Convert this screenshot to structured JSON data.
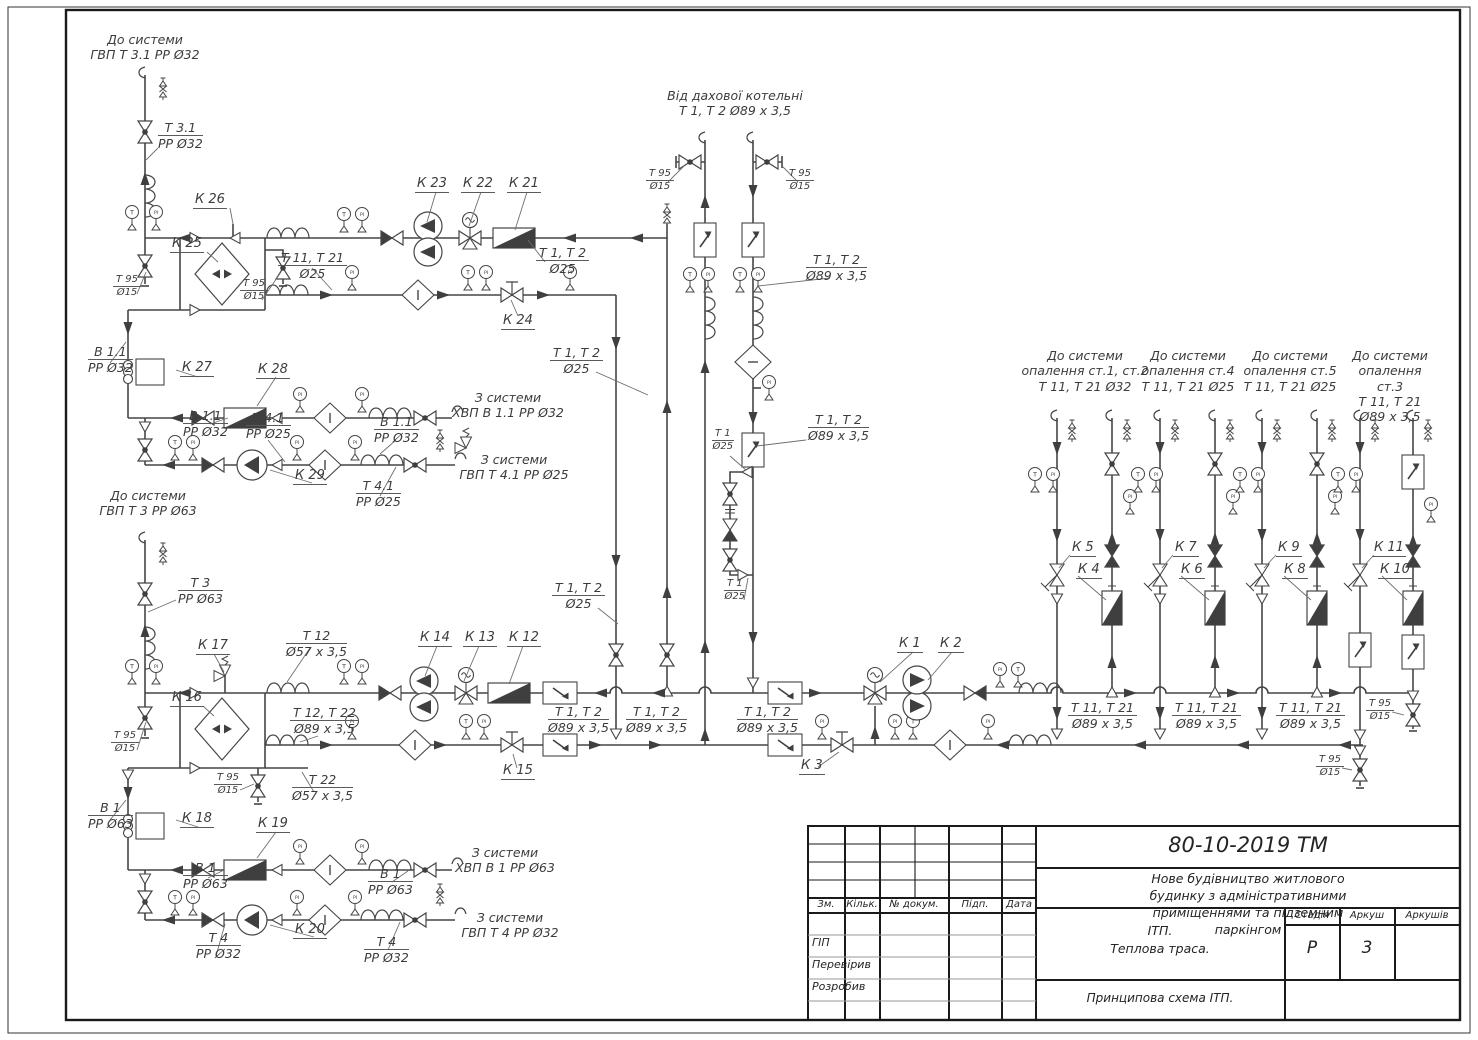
{
  "headers": {
    "to_gvp31": "До системи\nГВП Т 3.1 РР Ø32",
    "from_roof": "Від дахової котельні\nТ 1, Т 2 Ø89 х 3,5",
    "to_gvp3": "До системи\nГВП Т 3 РР Ø63",
    "to_heat_st12": "До системи\nопалення ст.1, ст.2\nТ 11, Т 21 Ø32",
    "to_heat_st4": "До системи\nопалення ст.4\nТ 11, Т 21 Ø25",
    "to_heat_st5": "До системи\nопалення ст.5\nТ 11, Т 21 Ø25",
    "to_heat_st3": "До системи\nопалення ст.3\nТ 11, Т 21 Ø89 х 3,5",
    "from_hvp11": "З системи\nХВП В 1.1  РР Ø32",
    "from_gvp41": "З системи\nГВП Т 4.1  РР Ø25",
    "from_hvp1": "З системи\nХВП В 1  РР Ø63",
    "from_gvp4": "З системи\nГВП Т 4  РР Ø32"
  },
  "equipment": {
    "k1": "К 1",
    "k2": "К 2",
    "k3": "К 3",
    "k4": "К 4",
    "k5": "К 5",
    "k6": "К 6",
    "k7": "К 7",
    "k8": "К 8",
    "k9": "К 9",
    "k10": "К 10",
    "k11": "К 11",
    "k12": "К 12",
    "k13": "К 13",
    "k14": "К 14",
    "k15": "К 15",
    "k16": "К 16",
    "k17": "К 17",
    "k18": "К 18",
    "k19": "К 19",
    "k20": "К 20",
    "k21": "К 21",
    "k22": "К 22",
    "k23": "К 23",
    "k24": "К 24",
    "k25": "К 25",
    "k26": "К 26",
    "k27": "К 27",
    "k28": "К 28",
    "k29": "К 29"
  },
  "pipes": {
    "t31": {
      "a": "Т 3.1",
      "b": "РР Ø32"
    },
    "t95": {
      "a": "Т 95",
      "b": "Ø15"
    },
    "t11t21_25": {
      "a": "Т 11, Т 21",
      "b": "Ø25"
    },
    "t1t2_25": {
      "a": "Т 1, Т 2",
      "b": "Ø25"
    },
    "t1t2_89": {
      "a": "Т 1, Т 2",
      "b": "Ø89 х 3,5"
    },
    "t1_25": {
      "a": "Т 1",
      "b": "Ø25"
    },
    "b11": {
      "a": "В 1.1",
      "b": "РР Ø32"
    },
    "t41": {
      "a": "Т 4.1",
      "b": "РР Ø25"
    },
    "t3": {
      "a": "Т 3",
      "b": "РР Ø63"
    },
    "t12": {
      "a": "Т 12",
      "b": "Ø57 х 3,5"
    },
    "t12t22": {
      "a": "Т 12, Т 22",
      "b": "Ø89 х 3,5"
    },
    "t22": {
      "a": "Т 22",
      "b": "Ø57 х 3,5"
    },
    "b1": {
      "a": "В 1",
      "b": "РР Ø63"
    },
    "t4": {
      "a": "Т 4",
      "b": "РР Ø32"
    },
    "t11t21_89": {
      "a": "Т 11, Т 21",
      "b": "Ø89 х 3,5"
    }
  },
  "symbols": {
    "gauge_t": "Т",
    "gauge_pi": "РІ"
  },
  "title_block": {
    "doc_code": "80-10-2019  ТМ",
    "project": "Нове будівництво житлового будинку з адміністративними\nприміщеннями та підземним паркінгом",
    "object": "ІТП.\nТеплова траса.",
    "sheet_title": "Принципова схема ІТП.",
    "cols": {
      "zm": "Зм.",
      "kilk": "Кільк.",
      "doc": "№ докум.",
      "pidp": "Підп.",
      "data": "Дата"
    },
    "roles": {
      "gip": "ГІП",
      "checked": "Перевірив",
      "developed": "Розробив"
    },
    "stage_label": "Стадія",
    "sheet_label": "Аркуш",
    "sheets_label": "Аркушів",
    "stage": "Р",
    "sheet": "3",
    "sheets": ""
  }
}
